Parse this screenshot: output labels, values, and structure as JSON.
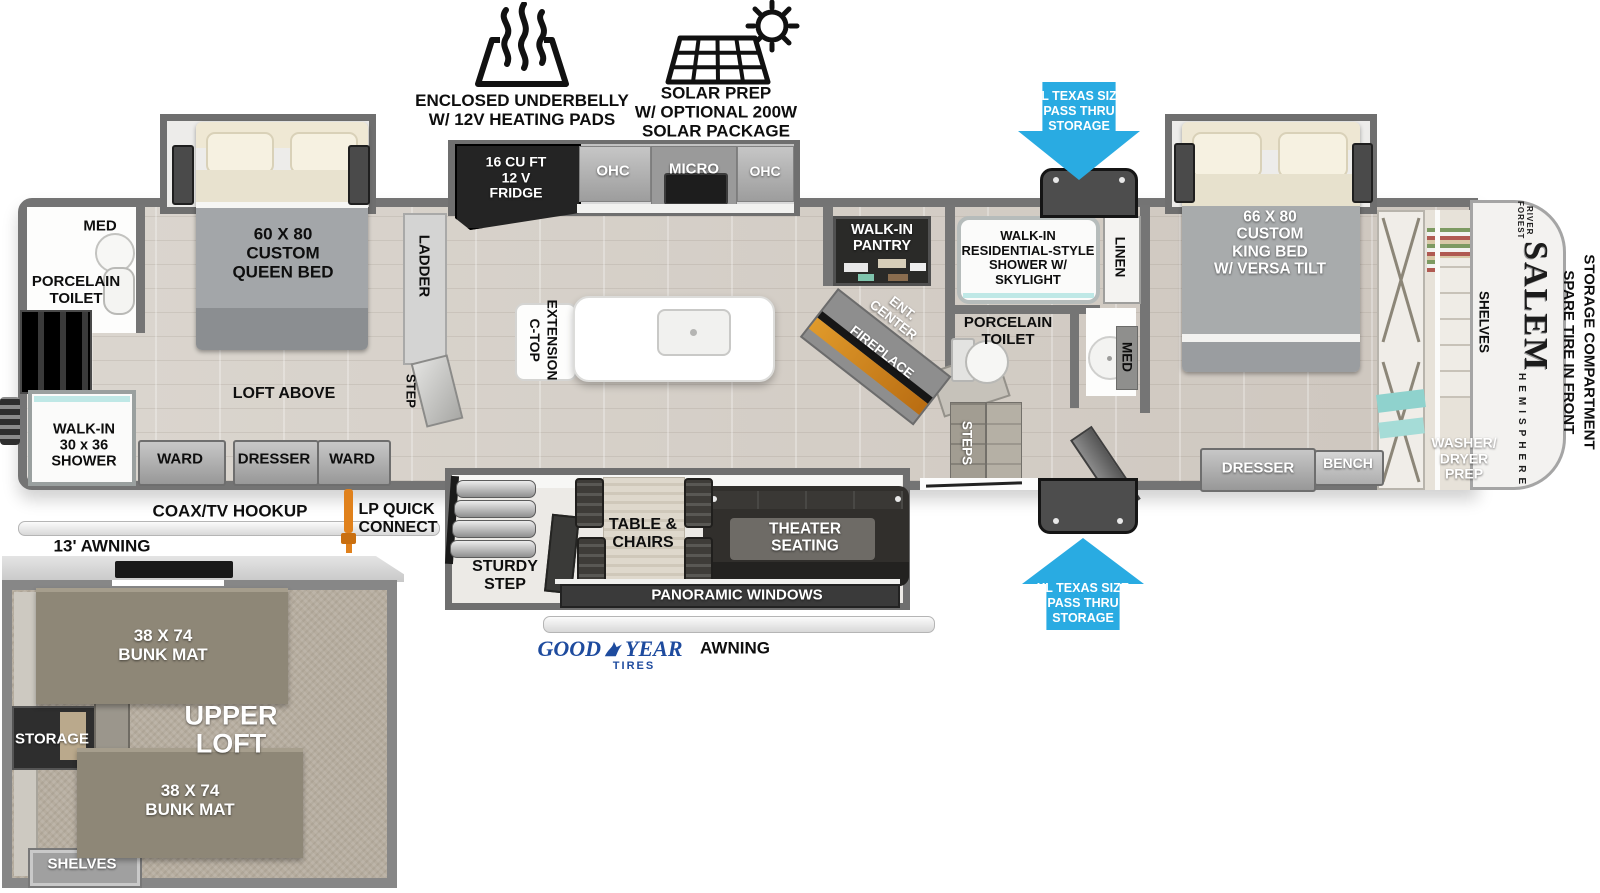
{
  "meta": {
    "title": "Salem Hemisphere fifth wheel floor plan",
    "width_px": 1600,
    "height_px": 893
  },
  "colors": {
    "arrow_blue": "#29abe2",
    "goodyear_blue": "#1e4b9e",
    "fireplace_orange": "#dd8a20",
    "teal_accent": "#8fd2cd",
    "wall_gray": "#757575",
    "appliance_dark": "#242424"
  },
  "icons": {
    "heat": "heat-waves-icon",
    "solar": "solar-panel-sun-icon",
    "pass_thru_top": "arrow-down-icon",
    "pass_thru_bottom": "arrow-up-icon",
    "goodyear": "wingfoot-icon",
    "lp": "lp-connector-icon",
    "rear_ladder": "rear-ladder-icon"
  },
  "top_features": {
    "underbelly": "ENCLOSED UNDERBELLY\nW/ 12V HEATING PADS",
    "solar": "SOLAR PREP\nW/ OPTIONAL 200W\nSOLAR PACKAGE"
  },
  "storage": {
    "pass_thru_top": "XL TEXAS SIZE\nPASS THRU\nSTORAGE",
    "pass_thru_bottom": "XL TEXAS SIZE\nPASS THRU\nSTORAGE",
    "spare_tire": "SPARE TIRE IN FRONT\nSTORAGE COMPARTMENT"
  },
  "rear_bedroom": {
    "med": "MED",
    "toilet": "PORCELAIN\nTOILET",
    "queen_bed": "60 X  80\nCUSTOM\nQUEEN BED",
    "ladder": "LADDER",
    "loft_above": "LOFT ABOVE",
    "shower": "WALK-IN\n30 x 36\nSHOWER",
    "ward1": "WARD",
    "dresser": "DRESSER",
    "ward2": "WARD",
    "step": "STEP"
  },
  "kitchen": {
    "fridge": "16 CU FT\n12 V\nFRIDGE",
    "ohc_left": "OHC",
    "micro": "MICRO",
    "ohc_right": "OHC",
    "ctop": "C-TOP\nEXTENSION",
    "pantry": "WALK-IN\nPANTRY",
    "ent_center": "ENT.\nCENTER",
    "fireplace": "FIREPLACE"
  },
  "bathroom": {
    "shower": "WALK-IN\nRESIDENTIAL-STYLE\nSHOWER W/\nSKYLIGHT",
    "linen": "LINEN",
    "toilet": "PORCELAIN\nTOILET",
    "med": "MED",
    "steps": "STEPS"
  },
  "front_bedroom": {
    "king_bed": "66 X  80\nCUSTOM\nKING BED\nW/ VERSA TILT",
    "shelves": "SHELVES",
    "washer_dryer": "WASHER/\nDRYER\nPREP",
    "dresser": "DRESSER",
    "bench": "BENCH"
  },
  "living": {
    "sturdy_step": "STURDY\nSTEP",
    "table_chairs": "TABLE &\nCHAIRS",
    "theater": "THEATER\nSEATING",
    "panoramic": "PANORAMIC WINDOWS",
    "awning": "AWNING"
  },
  "exterior": {
    "coax": "COAX/TV HOOKUP",
    "lp": "LP QUICK\nCONNECT",
    "awning_13": "13' AWNING",
    "goodyear_good": "GOOD",
    "goodyear_year": "YEAR",
    "goodyear_tires": "TIRES"
  },
  "loft": {
    "bunk_top": "38 X 74\nBUNK MAT",
    "bunk_bottom": "38 X 74\nBUNK MAT",
    "storage": "STORAGE",
    "title": "UPPER\nLOFT",
    "shelves": "SHELVES"
  },
  "brand": {
    "forest_river": "FOREST RIVER",
    "salem": "SALEM",
    "hemisphere": "HEMISPHERE"
  }
}
